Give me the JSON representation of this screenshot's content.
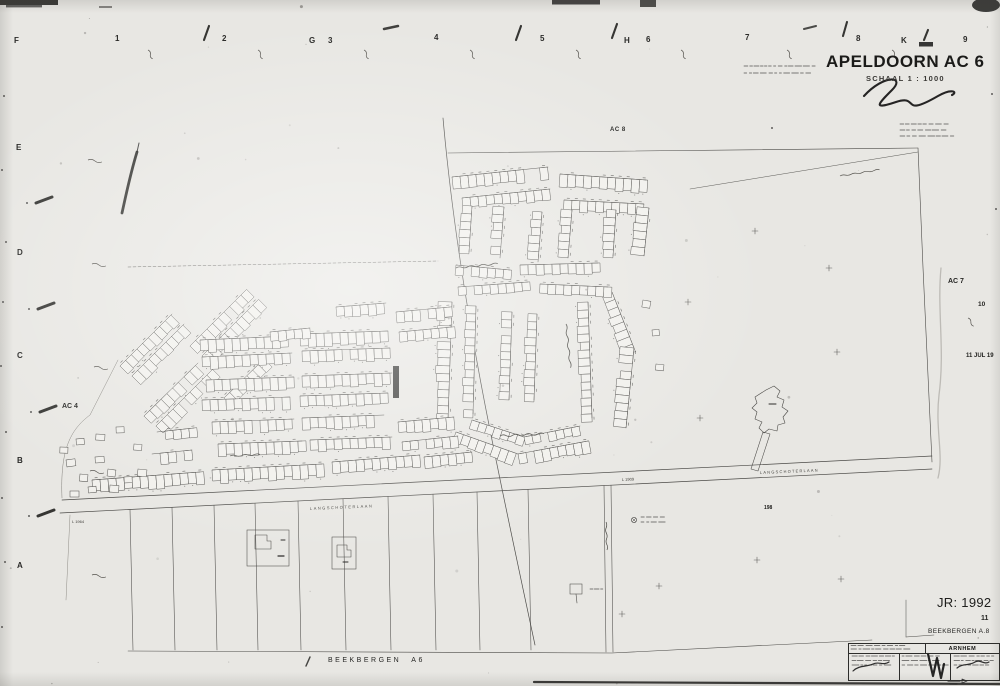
{
  "sheet": {
    "title": "APELDOORN AC 6",
    "scale": "SCHAAL 1 : 1000",
    "year": "JR: 1992",
    "sheet_no": "11",
    "neighbor_bottom_label": "BEEKBERGEN A.8",
    "neighbor_bottom_edge": "BEEKBERGEN A6",
    "neighbor_top": "AC 8",
    "neighbor_right": "AC 7",
    "neighbor_right_no": "10",
    "neighbor_left": "AC 4",
    "date_stamp": "11 JUL 19",
    "titleblock": {
      "office": "ARNHEM"
    }
  },
  "grid": {
    "top": [
      "F",
      "1",
      "2",
      "G",
      "3",
      "4",
      "5",
      "H",
      "6",
      "7",
      "8",
      "K",
      "9"
    ],
    "left": [
      "E",
      "D",
      "C",
      "B",
      "A"
    ]
  },
  "map": {
    "road_label": "LANGSCHOTERLAAN",
    "parcel_codes": [
      "L 1964",
      "L 1909"
    ],
    "survey_code": "198"
  },
  "colors": {
    "paper": "#e8e7e3",
    "ink": "#2e2d2b",
    "line": "#4b4a47",
    "faint": "#99968f"
  }
}
